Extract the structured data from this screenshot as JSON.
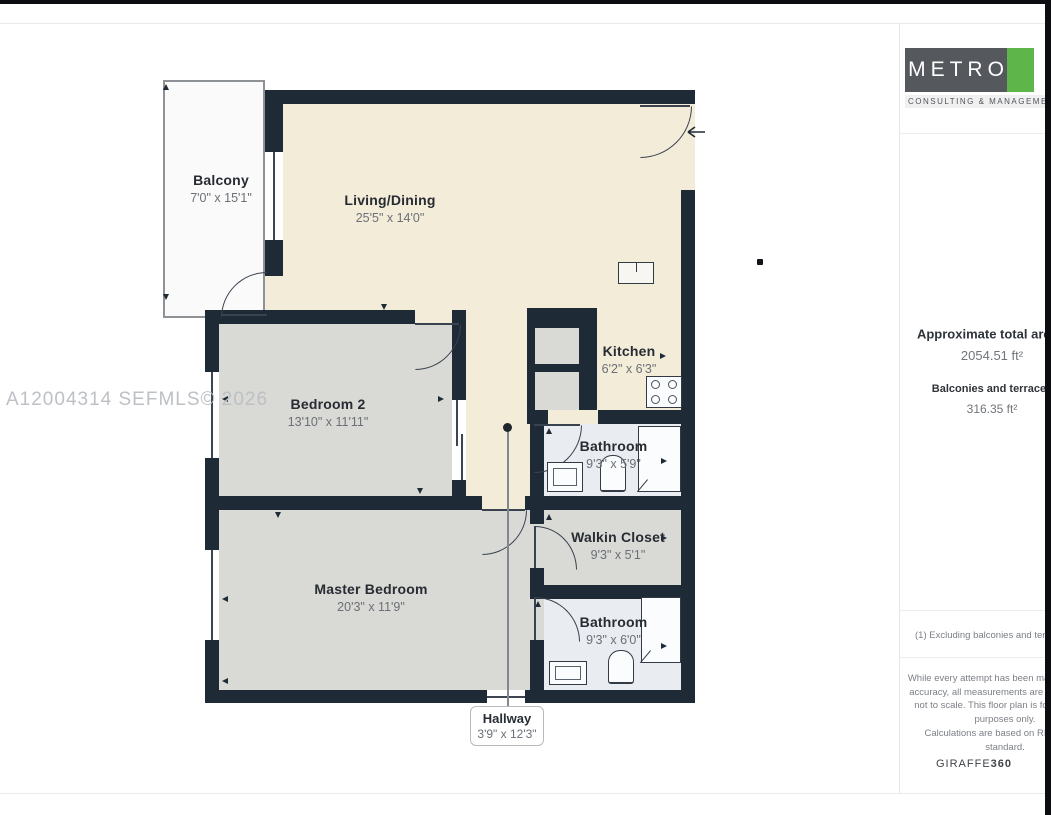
{
  "page": {
    "watermark": "A12004314 SEFMLS© 2026"
  },
  "plan": {
    "rooms": [
      {
        "name": "Balcony",
        "dims": "7'0\" x 15'1\""
      },
      {
        "name": "Living/Dining",
        "dims": "25'5\" x 14'0\""
      },
      {
        "name": "Kitchen",
        "dims": "6'2\" x 6'3\""
      },
      {
        "name": "Bedroom 2",
        "dims": "13'10\" x 11'11\""
      },
      {
        "name": "Bathroom",
        "dims": "9'3\" x 5'9\""
      },
      {
        "name": "Walkin Closet",
        "dims": "9'3\" x 5'1\""
      },
      {
        "name": "Master Bedroom",
        "dims": "20'3\" x 11'9\""
      },
      {
        "name": "Bathroom",
        "dims": "9'3\" x 6'0\""
      },
      {
        "name": "Hallway",
        "dims": "3'9\" x 12'3\""
      }
    ],
    "colors": {
      "wall": "#1f2a37",
      "living_area": "#f3ecd9",
      "bedroom_area": "#d9d9d5",
      "bathroom_area": "#e9ecf1",
      "balcony_area": "#fafafa"
    }
  },
  "sidebar": {
    "brand": "METRO",
    "brand_tagline": "CONSULTING & MANAGEMENT",
    "area_title": "Approximate total area",
    "area_note_marker": "(1)",
    "area_value": "2054.51 ft²",
    "balconies_label": "Balconies and terraces",
    "balconies_value": "316.35 ft²",
    "footnote": "(1) Excluding balconies and terraces",
    "disclaimer": "While every attempt has been made to ensure accuracy, all measurements are approximate, not to scale. This floor plan is for illustrative purposes only.",
    "standards_note": "Calculations are based on RICS IPMS standard.",
    "generator": "GIRAFFE",
    "generator_suffix": "360",
    "brand_colors": {
      "logo_bg": "#55585c",
      "logo_accent": "#5eb54a"
    }
  }
}
